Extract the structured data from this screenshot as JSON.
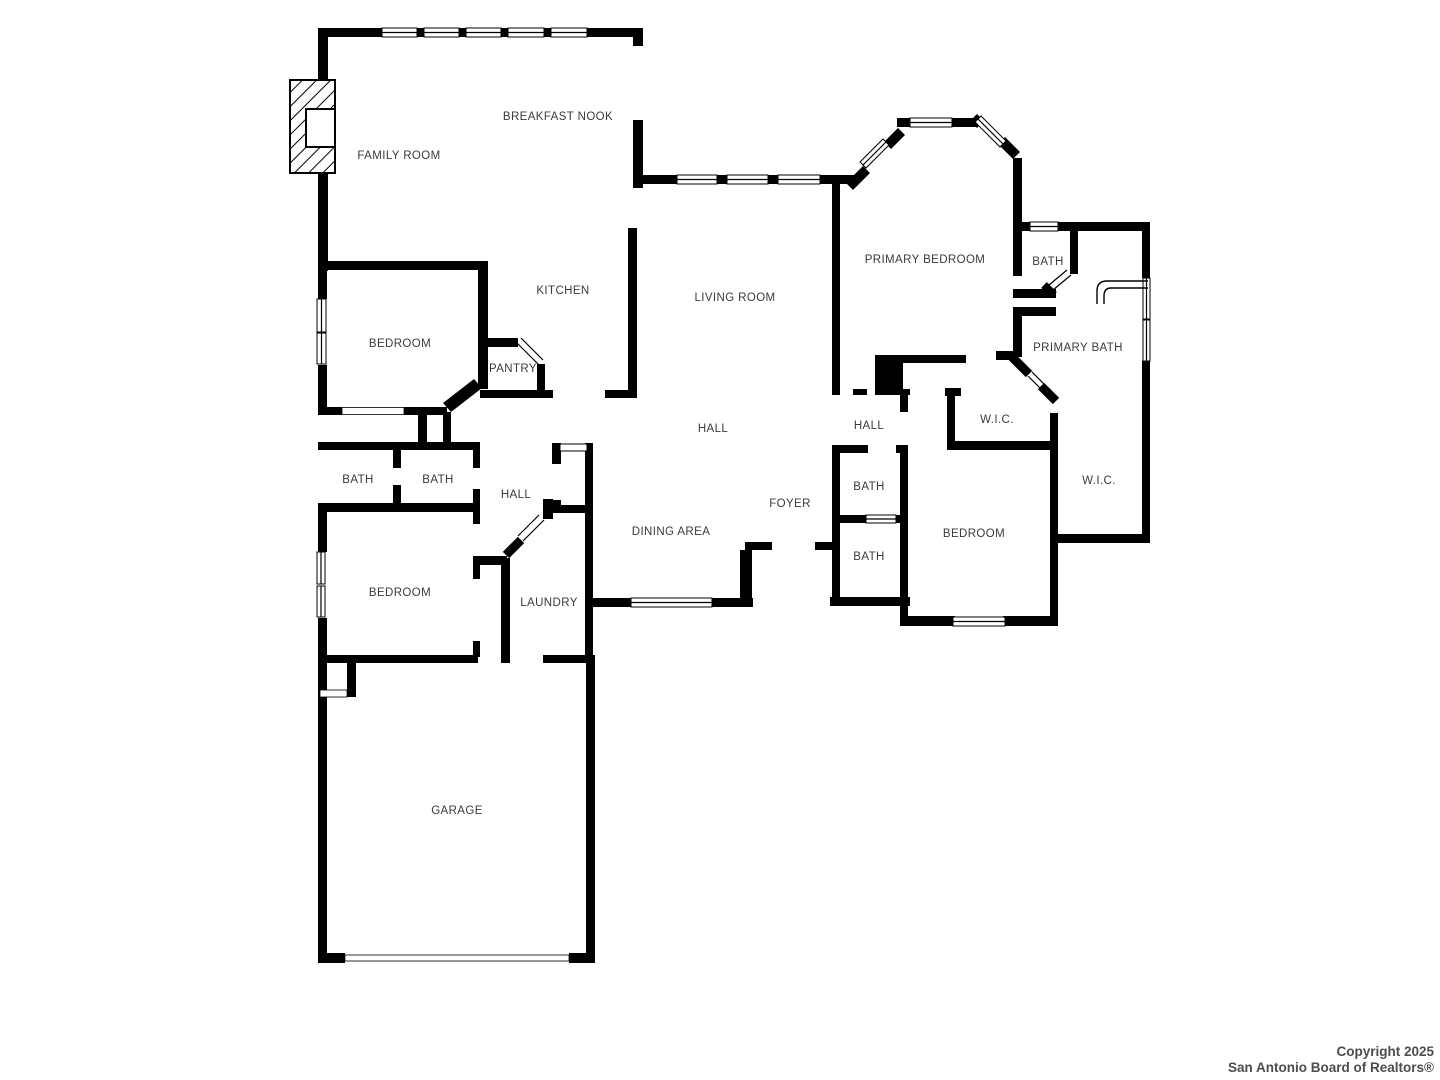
{
  "plan": {
    "colors": {
      "background": "#ffffff",
      "walls": "#000000",
      "label_text": "#3b3b3b",
      "copyright_text": "#4d4d4d"
    },
    "rooms": [
      {
        "label": "BREAKFAST NOOK",
        "x": 558,
        "y": 116
      },
      {
        "label": "FAMILY ROOM",
        "x": 399,
        "y": 155
      },
      {
        "label": "KITCHEN",
        "x": 563,
        "y": 290
      },
      {
        "label": "BEDROOM",
        "x": 400,
        "y": 343
      },
      {
        "label": "PANTRY",
        "x": 513,
        "y": 368
      },
      {
        "label": "LIVING ROOM",
        "x": 735,
        "y": 297
      },
      {
        "label": "PRIMARY BEDROOM",
        "x": 925,
        "y": 259
      },
      {
        "label": "BATH",
        "x": 1048,
        "y": 261
      },
      {
        "label": "PRIMARY BATH",
        "x": 1078,
        "y": 347
      },
      {
        "label": "HALL",
        "x": 869,
        "y": 425
      },
      {
        "label": "W.I.C.",
        "x": 997,
        "y": 419
      },
      {
        "label": "W.I.C.",
        "x": 1099,
        "y": 480
      },
      {
        "label": "BATH",
        "x": 358,
        "y": 479
      },
      {
        "label": "BATH",
        "x": 438,
        "y": 479
      },
      {
        "label": "HALL",
        "x": 516,
        "y": 494
      },
      {
        "label": "HALL",
        "x": 713,
        "y": 428
      },
      {
        "label": "FOYER",
        "x": 790,
        "y": 503
      },
      {
        "label": "DINING AREA",
        "x": 671,
        "y": 531
      },
      {
        "label": "BATH",
        "x": 869,
        "y": 486
      },
      {
        "label": "BATH",
        "x": 869,
        "y": 556
      },
      {
        "label": "BEDROOM",
        "x": 974,
        "y": 533
      },
      {
        "label": "BEDROOM",
        "x": 400,
        "y": 592
      },
      {
        "label": "LAUNDRY",
        "x": 549,
        "y": 602
      },
      {
        "label": "GARAGE",
        "x": 457,
        "y": 810
      }
    ],
    "footer": {
      "line1": "Copyright 2025",
      "line2": "San Antonio Board of Realtors®"
    }
  }
}
